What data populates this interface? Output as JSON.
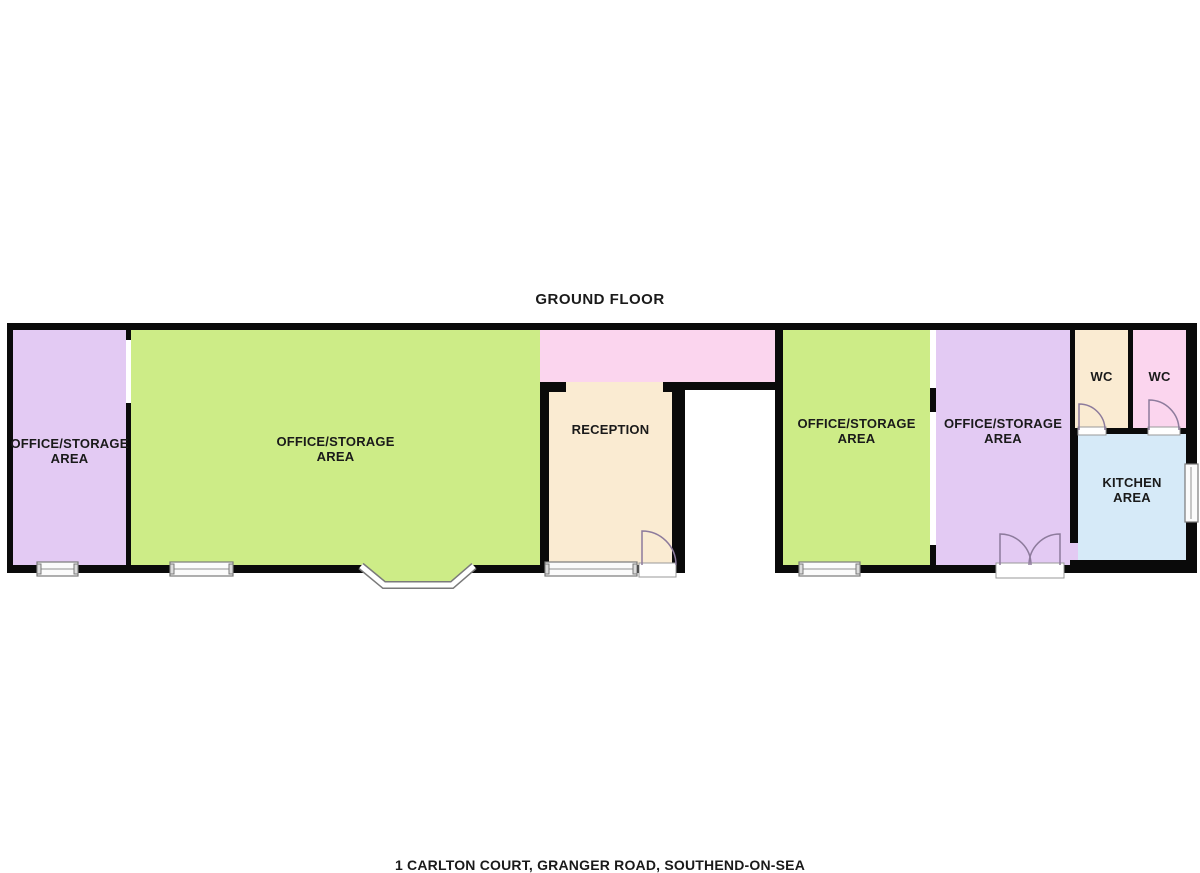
{
  "title": "GROUND FLOOR",
  "caption": "1 CARLTON COURT, GRANGER ROAD, SOUTHEND-ON-SEA",
  "rooms": {
    "office_storage_left": {
      "label": "OFFICE/STORAGE\nAREA"
    },
    "office_storage_main": {
      "label": "OFFICE/STORAGE\nAREA"
    },
    "corridor": {
      "label": ""
    },
    "reception": {
      "label": "RECEPTION"
    },
    "office_storage_right_1": {
      "label": "OFFICE/STORAGE\nAREA"
    },
    "office_storage_right_2": {
      "label": "OFFICE/STORAGE\nAREA"
    },
    "wc_left": {
      "label": "WC"
    },
    "wc_right": {
      "label": "WC"
    },
    "kitchen": {
      "label": "KITCHEN\nAREA"
    }
  },
  "palette": {
    "wall": "#0a0a0a",
    "purple": "#E3CAF3",
    "green": "#CDEC87",
    "pink": "#FBD5EE",
    "cream": "#FAEBD2",
    "blue": "#D6EAF8",
    "door": "#8d7b9c",
    "winborder": "#7a7a7a",
    "text": "#1a1a1a"
  }
}
